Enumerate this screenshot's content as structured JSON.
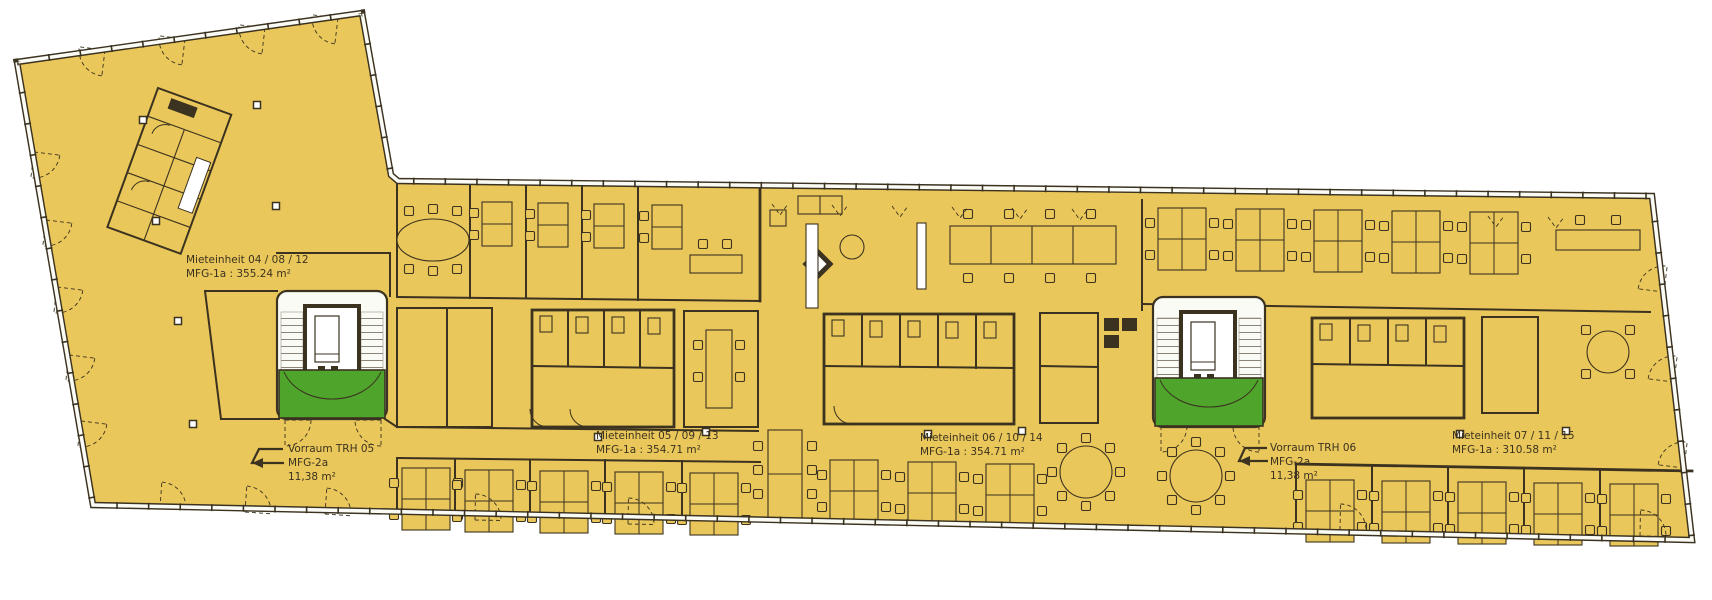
{
  "plan": {
    "unit_labels": [
      {
        "line1": "Mieteinheit 04 / 08 / 12",
        "line2": "MFG-1a : 355.24 m²"
      },
      {
        "line1": "Mieteinheit 05 / 09 / 13",
        "line2": "MFG-1a : 354.71 m²"
      },
      {
        "line1": "Mieteinheit 06 / 10 / 14",
        "line2": "MFG-1a : 354.71 m²"
      },
      {
        "line1": "Mieteinheit 07 / 11 / 15",
        "line2": "MFG-1a : 310.58 m²"
      }
    ],
    "stair_labels": [
      {
        "line1": "Vorraum TRH 05",
        "line2": "MFG-2a",
        "line3": "11,38 m²"
      },
      {
        "line1": "Vorraum TRH 06",
        "line2": "MFG-2a",
        "line3": "11,38 m²"
      }
    ]
  },
  "colors": {
    "floor": "#EAC75A",
    "wall": "#3B3220",
    "green": "#4FA42B",
    "stair": "#FBFBF6",
    "paper": "#FFFFFF"
  }
}
